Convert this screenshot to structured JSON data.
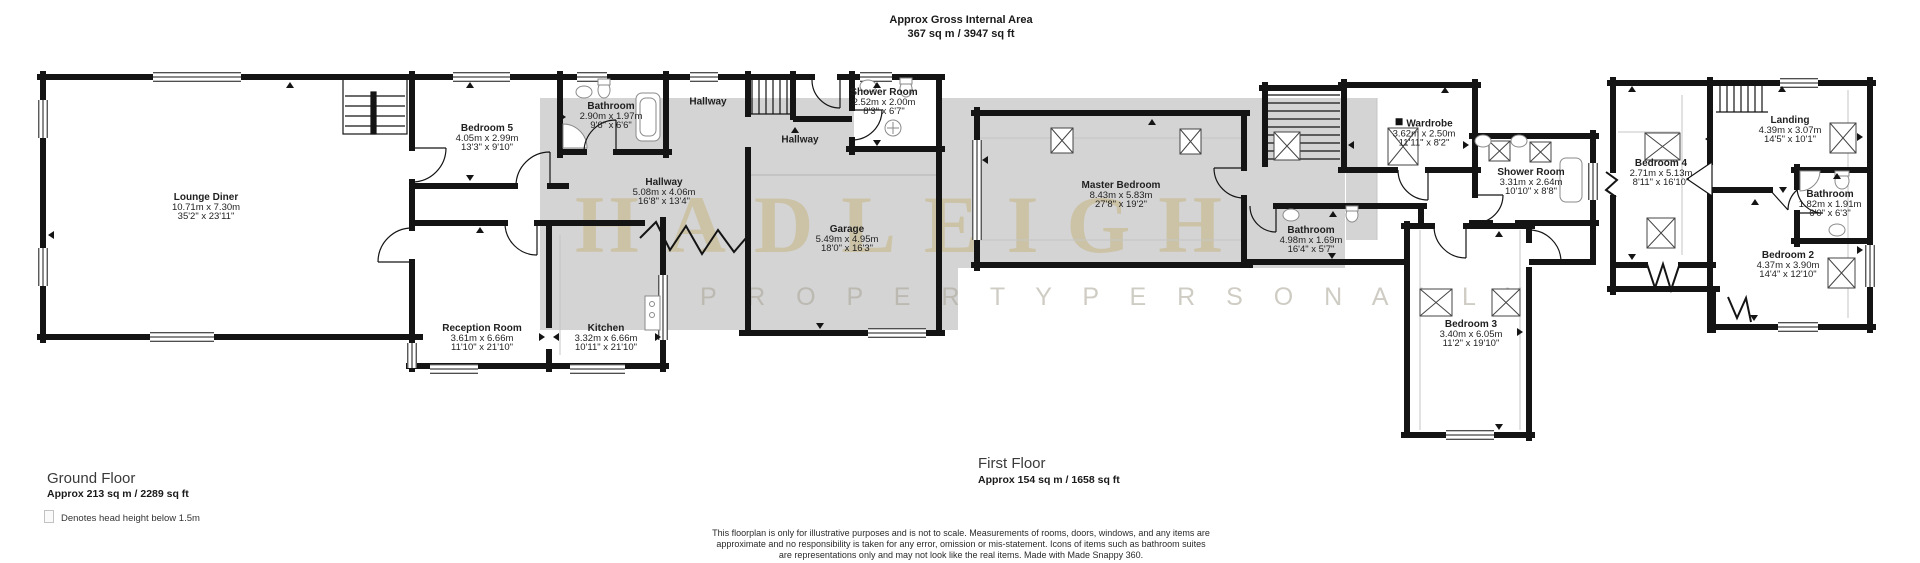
{
  "header": {
    "line1": "Approx Gross Internal Area",
    "line2": "367 sq m / 3947 sq ft"
  },
  "watermark": {
    "line1": "HADLEIGH",
    "line2": "P R O P E R T Y   P E R S O N A L L Y"
  },
  "ground": {
    "title": "Ground Floor",
    "area": "Approx 213 sq m / 2289 sq ft",
    "legend": "Denotes head height below 1.5m",
    "rooms": [
      {
        "name": "Lounge Diner",
        "metric": "10.71m x 7.30m",
        "imperial": "35'2\" x 23'11\""
      },
      {
        "name": "Bedroom 5",
        "metric": "4.05m x 2.99m",
        "imperial": "13'3\" x 9'10\""
      },
      {
        "name": "Bathroom",
        "metric": "2.90m x 1.97m",
        "imperial": "9'6\" x 6'6\""
      },
      {
        "name": "Hallway"
      },
      {
        "name": "Hallway"
      },
      {
        "name": "Hallway",
        "metric": "5.08m x 4.06m",
        "imperial": "16'8\" x 13'4\""
      },
      {
        "name": "Shower Room",
        "metric": "2.52m x 2.00m",
        "imperial": "8'3\" x 6'7\""
      },
      {
        "name": "Garage",
        "metric": "5.49m x 4.95m",
        "imperial": "18'0\" x 16'3\""
      },
      {
        "name": "Reception Room",
        "metric": "3.61m x 6.66m",
        "imperial": "11'10\" x 21'10\""
      },
      {
        "name": "Kitchen",
        "metric": "3.32m x 6.66m",
        "imperial": "10'11\" x 21'10\""
      }
    ]
  },
  "first": {
    "title": "First Floor",
    "area": "Approx 154 sq m / 1658 sq ft",
    "rooms": [
      {
        "name": "Master Bedroom",
        "metric": "8.43m x 5.83m",
        "imperial": "27'8\" x 19'2\""
      },
      {
        "name": "Wardrobe",
        "metric": "3.62m x 2.50m",
        "imperial": "11'11\" x 8'2\""
      },
      {
        "name": "Shower Room",
        "metric": "3.31m x 2.64m",
        "imperial": "10'10\" x 8'8\""
      },
      {
        "name": "Bathroom",
        "metric": "4.98m x 1.69m",
        "imperial": "16'4\" x 5'7\""
      },
      {
        "name": "Bedroom 3",
        "metric": "3.40m x 6.05m",
        "imperial": "11'2\" x 19'10\""
      },
      {
        "name": "Bedroom 4",
        "metric": "2.71m x 5.13m",
        "imperial": "8'11\" x 16'10\""
      },
      {
        "name": "Landing",
        "metric": "4.39m x 3.07m",
        "imperial": "14'5\" x 10'1\""
      },
      {
        "name": "Bathroom",
        "metric": "1.82m x 1.91m",
        "imperial": "6'0\" x 6'3\""
      },
      {
        "name": "Bedroom 2",
        "metric": "4.37m x 3.90m",
        "imperial": "14'4\" x 12'10\""
      }
    ]
  },
  "disclaimer": "This floorplan is only for illustrative purposes and is not to scale. Measurements of rooms, doors, windows, and any items are approximate and no responsibility is taken for any error, omission or mis-statement. Icons of items such as bathroom suites are representations only and may not look like the real items. Made with Made Snappy 360.",
  "colors": {
    "wall": "#141414",
    "overlay_gray": "#d4d4d5",
    "watermark_tan": "#c4b482"
  }
}
